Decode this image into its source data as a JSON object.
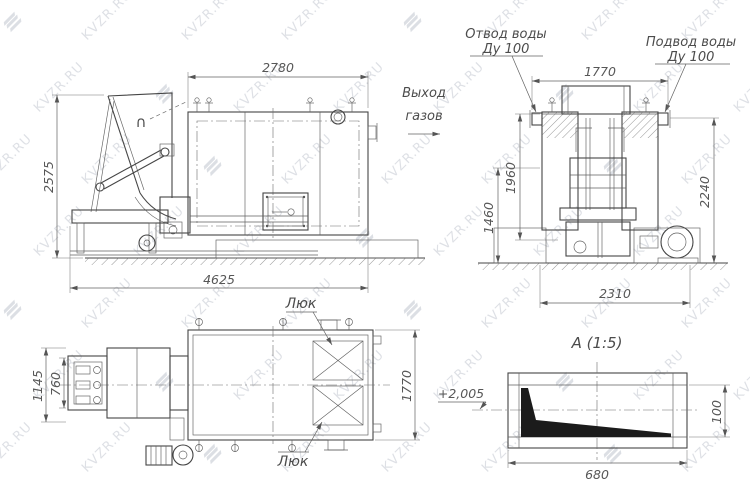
{
  "watermark": {
    "text": "KVZR.RU"
  },
  "front_view": {
    "dim_width_top": "2780",
    "dim_height_left": "2575",
    "dim_length_bottom": "4625",
    "hopper_marker": "∩"
  },
  "side_view": {
    "label_gas_out_line1": "Выход",
    "label_gas_out_line2": "газов",
    "label_water_out_line1": "Отвод воды",
    "label_water_out_line2": "Ду 100",
    "label_water_in_line1": "Подвод воды",
    "label_water_in_line2": "Ду 100",
    "dim_width_top": "1770",
    "dim_height_body": "1960",
    "dim_height_lower": "1460",
    "dim_height_overall": "2240",
    "dim_width_bottom": "2310"
  },
  "plan_view": {
    "label_hatch_top": "Люк",
    "label_hatch_bottom": "Люк",
    "dim_feeder_outer": "1145",
    "dim_feeder_inner": "760",
    "dim_width_right": "1770"
  },
  "detail_a": {
    "title": "А  (1:5)",
    "label_elevation": "+2,005",
    "dim_width": "680",
    "dim_height": "100"
  }
}
